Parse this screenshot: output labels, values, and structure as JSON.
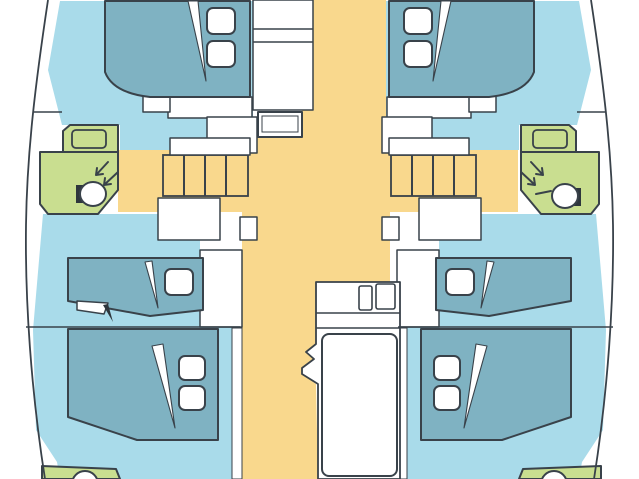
{
  "diagram": {
    "type": "floor-plan",
    "subject": "catamaran-interior-layout",
    "cabins": 4,
    "bathrooms": 4,
    "staircases": 2
  },
  "colors": {
    "background": "#ffffff",
    "outline": "#39424a",
    "hull": "#a9dbea",
    "bed": "#7fb2c2",
    "bathroom": "#c9de90",
    "walkway": "#f9d88d",
    "white": "#ffffff",
    "dark": "#2e363c"
  }
}
